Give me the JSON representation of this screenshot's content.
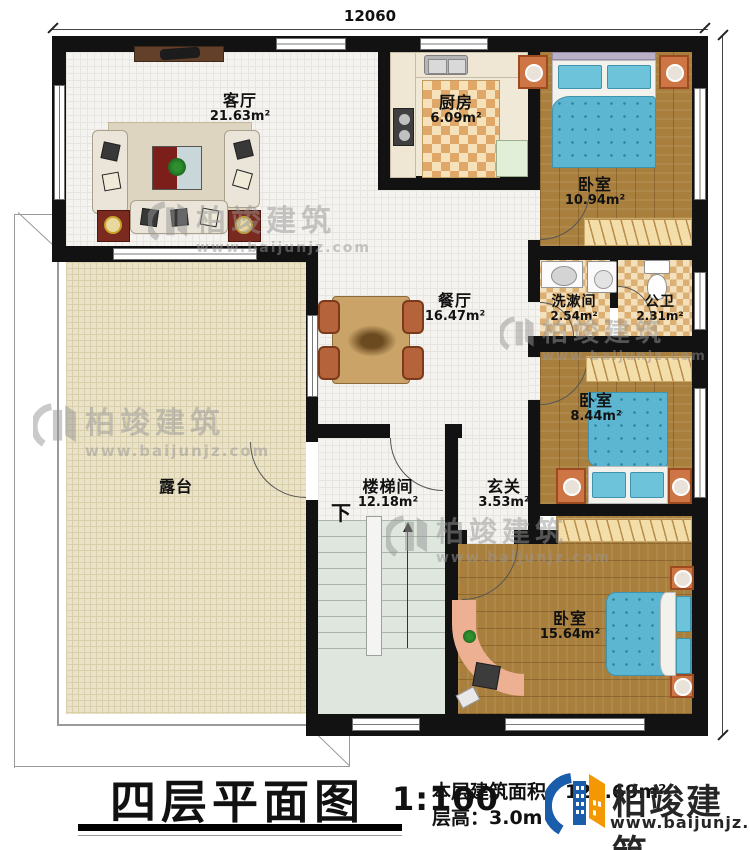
{
  "dimensions": {
    "top": "12060",
    "right": "12760"
  },
  "rooms": {
    "living": {
      "name": "客厅",
      "area": "21.63m²"
    },
    "kitchen": {
      "name": "厨房",
      "area": "6.09m²"
    },
    "bedroom_top": {
      "name": "卧室",
      "area": "10.94m²"
    },
    "dining": {
      "name": "餐厅",
      "area": "16.47m²"
    },
    "washroom": {
      "name": "洗漱间",
      "area": "2.54m²"
    },
    "toilet": {
      "name": "公卫",
      "area": "2.31m²"
    },
    "bedroom_mid": {
      "name": "卧室",
      "area": "8.44m²"
    },
    "terrace": {
      "name": "露台"
    },
    "stairwell": {
      "name": "楼梯间",
      "area": "12.18m²"
    },
    "foyer": {
      "name": "玄关",
      "area": "3.53m²"
    },
    "bedroom_bottom": {
      "name": "卧室",
      "area": "15.64m²"
    }
  },
  "stairs": {
    "down_label": "下"
  },
  "title_block": {
    "title": "四层平面图",
    "scale": "1:100",
    "floor_area": "本层建筑面积：122.69m²",
    "floor_height": "层高：3.0m"
  },
  "brand": {
    "name": "柏竣建筑",
    "url": "www.baijunjz.com",
    "blue": "#1a5dab",
    "orange": "#f39800"
  }
}
